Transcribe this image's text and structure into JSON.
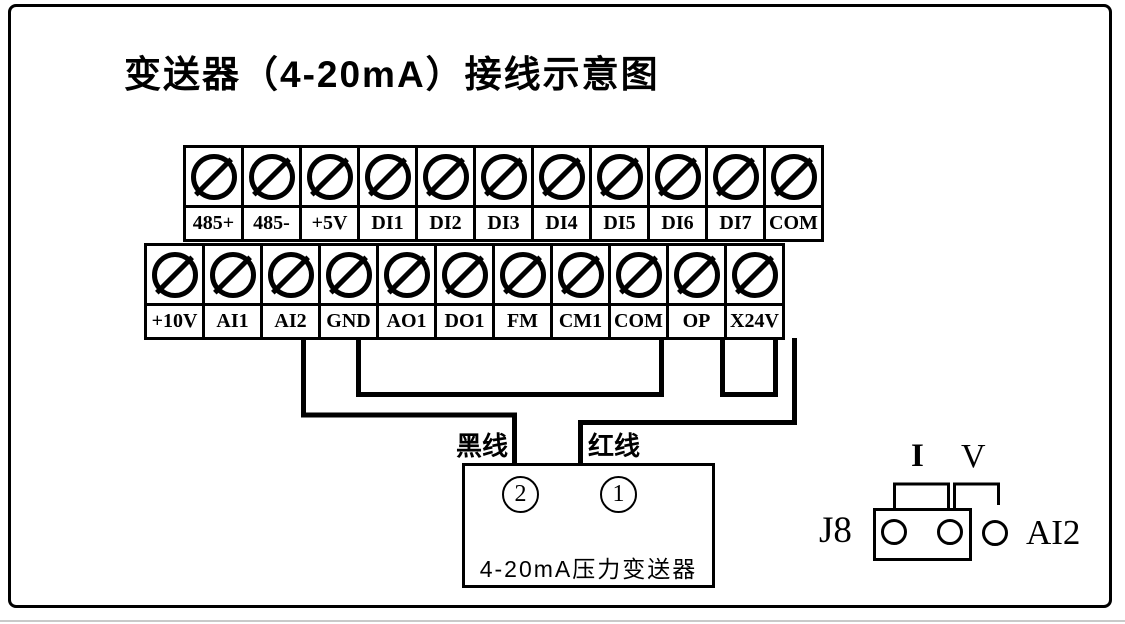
{
  "title": "变送器（4-20mA）接线示意图",
  "terminal_rows": {
    "row1": [
      "485+",
      "485-",
      "+5V",
      "DI1",
      "DI2",
      "DI3",
      "DI4",
      "DI5",
      "DI6",
      "DI7",
      "COM"
    ],
    "row2": [
      "+10V",
      "AI1",
      "AI2",
      "GND",
      "AO1",
      "DO1",
      "FM",
      "CM1",
      "COM",
      "OP",
      "X24V"
    ]
  },
  "wire_labels": {
    "black": "黑线",
    "red": "红线"
  },
  "transmitter": {
    "terminal_left": "2",
    "terminal_right": "1",
    "label": "4-20mA压力变送器"
  },
  "jumper": {
    "name": "J8",
    "current_mode": "I",
    "voltage_mode": "V",
    "channel": "AI2"
  },
  "connections": [
    {
      "from": "AI2",
      "to": "transmitter terminal 2",
      "wire": "黑线"
    },
    {
      "from": "GND",
      "to": "COM",
      "wire": ""
    },
    {
      "from": "OP",
      "to": "X24V",
      "wire": ""
    },
    {
      "from": "X24V",
      "to": "transmitter terminal 1",
      "wire": "红线"
    }
  ]
}
